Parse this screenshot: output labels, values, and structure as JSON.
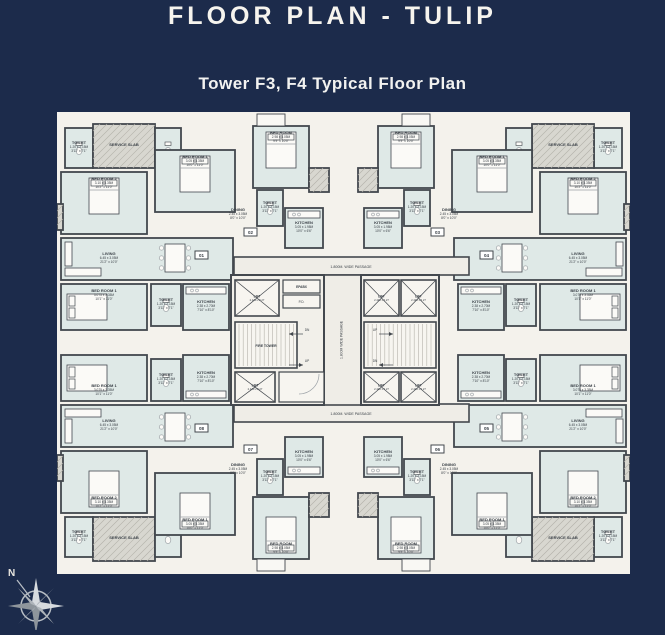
{
  "page": {
    "title": "FLOOR PLAN - TULIP",
    "subtitle": "Tower F3, F4 Typical Floor Plan"
  },
  "colors": {
    "background_navy": "#1c2b4b",
    "paper": "#f4f2ec",
    "room_fill": "#dfe9e7",
    "gray_fill": "#d8d7d0",
    "passage_fill": "#efede7",
    "wall": "#43484e",
    "furniture": "#9ba1a6",
    "label_text": "#3a4047"
  },
  "rooms": {
    "service_slab": {
      "name": "SERVICE SLAB",
      "m": "",
      "ft": ""
    },
    "toilet": {
      "name": "TOILET",
      "m": "1.20 x 2.15M",
      "ft": "3'11\" x 7'1\""
    },
    "bedroom2": {
      "name": "BED ROOM 2",
      "m": "3.10 x 3.35M",
      "ft": "10'2\" x 11'0\""
    },
    "bedroom1": {
      "name": "BED ROOM 1",
      "m": "3.05 x 3.35M",
      "ft": "10'0\" x 11'0\""
    },
    "bedroom1b": {
      "name": "BED ROOM 1",
      "m": "3.075 x 3.35M",
      "ft": "10'1\" x 11'0\""
    },
    "bedroom_inner": {
      "name": "BED ROOM",
      "m": "2.98 x 3.05M",
      "ft": "9'9\" x 10'0\""
    },
    "living": {
      "name": "LIVING",
      "m": "6.45 x 3.05M",
      "ft": "21'2\" x 10'0\""
    },
    "dining": {
      "name": "DINING",
      "m": "2.45 x 3.05M",
      "ft": "8'0\" x 10'0\""
    },
    "kitchen": {
      "name": "KITCHEN",
      "m": "3.05 x 1.98M",
      "ft": "10'0\" x 6'6\""
    },
    "kitchen_b": {
      "name": "KITCHEN",
      "m": "2.38 x 2.70M",
      "ft": "7'10\" x 8'10\""
    },
    "lift": {
      "name": "LIFT",
      "m": "2.440 x 2.27",
      "ft": ""
    },
    "fire_tower": {
      "name": "FIRE TOWER"
    },
    "epabx": {
      "name": "EPABX"
    },
    "pd": {
      "name": "P.D."
    },
    "up": {
      "name": "UP"
    },
    "dn": {
      "name": "DN"
    }
  },
  "passages": {
    "horizontal": "1.800M. WIDE PASSAGE",
    "vertical": "1.800M WIDE PASSAGE"
  },
  "unit_badges": [
    "01",
    "02",
    "03",
    "04",
    "05",
    "06",
    "07",
    "08"
  ],
  "compass": {
    "north_label": "N"
  }
}
